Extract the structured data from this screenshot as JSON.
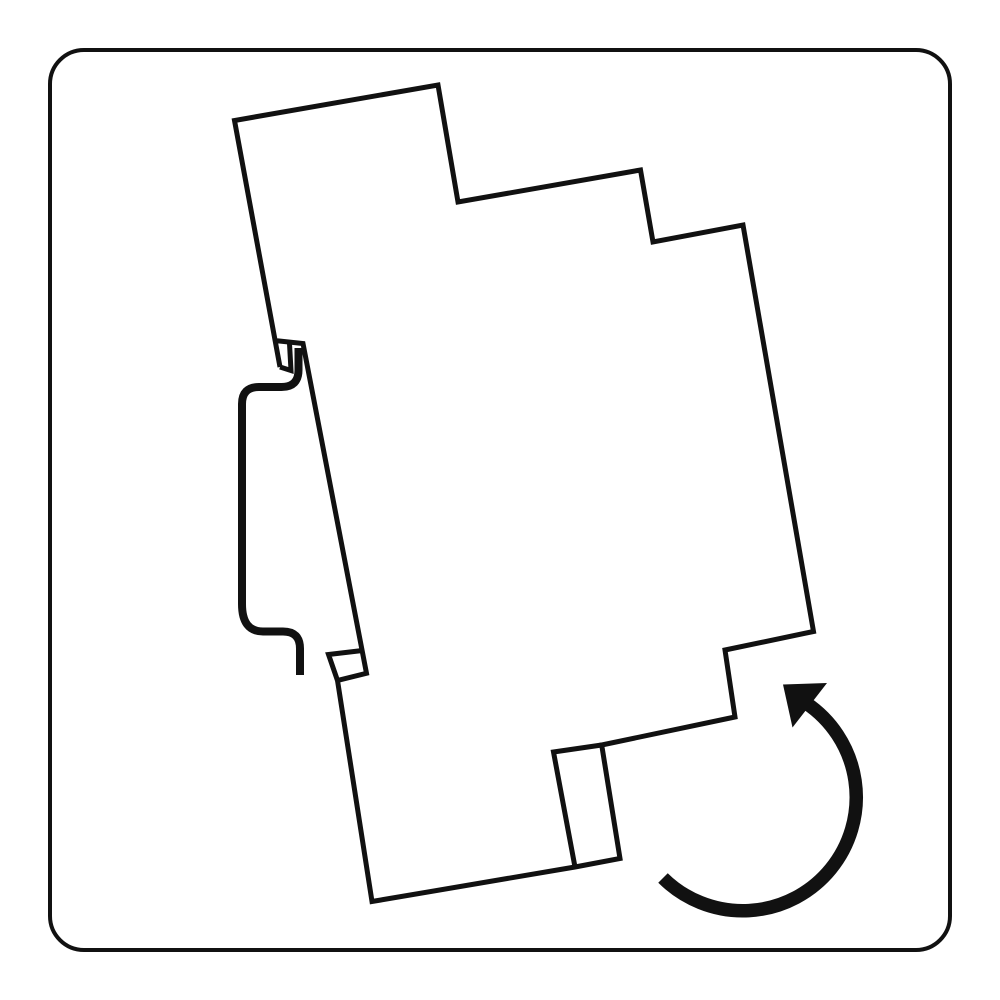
{
  "figure": {
    "kind": "technical-illustration",
    "subject": "din-rail-module-mounting-rotation",
    "has_text": false
  },
  "canvas": {
    "width": 1000,
    "height": 1000,
    "background": "#ffffff",
    "ink": "#111111"
  },
  "shapes": [
    {
      "name": "border-frame",
      "tag": "rect",
      "attrs": {
        "x": 50,
        "y": 50,
        "width": 900,
        "height": 900,
        "rx": 34,
        "ry": 34,
        "fill": "#ffffff",
        "stroke": "#111111",
        "stroke-width": 4
      }
    },
    {
      "name": "device-outline",
      "tag": "path",
      "attrs": {
        "d": "M 280 367 L 234.5 120.5 L 438 85 L 458 202 L 640.5 170 L 653 242 L 743 225 L 813.5 631.5 L 725 650 L 735 717 L 601.7 745 L 620 858.5 L 575 867 L 372 901.5 L 337.5 680.5 L 366.5 673.3 L 303 343.5 L 274.5 340.5",
        "fill": "none",
        "stroke": "#111111",
        "stroke-width": 5,
        "stroke-linejoin": "miter",
        "stroke-linecap": "butt"
      }
    },
    {
      "name": "upper-hook-slot",
      "tag": "path",
      "attrs": {
        "d": "M 280 367 L 291 370.5 L 289.5 343.5",
        "fill": "none",
        "stroke": "#111111",
        "stroke-width": 5,
        "stroke-linejoin": "miter",
        "stroke-linecap": "butt"
      }
    },
    {
      "name": "lower-snap-clip",
      "tag": "path",
      "attrs": {
        "d": "M 362.5 650.5 L 328.5 654.5 L 337.5 680.5",
        "fill": "none",
        "stroke": "#111111",
        "stroke-width": 5,
        "stroke-linejoin": "miter",
        "stroke-linecap": "butt"
      }
    },
    {
      "name": "release-tab",
      "tag": "path",
      "attrs": {
        "d": "M 601.7 745 L 553.5 752 L 575 867",
        "fill": "none",
        "stroke": "#111111",
        "stroke-width": 5,
        "stroke-linejoin": "miter",
        "stroke-linecap": "butt"
      }
    },
    {
      "name": "din-rail-profile",
      "tag": "path",
      "attrs": {
        "d": "M 298.5 348 L 298.5 370 Q 298.5 387 281.5 387 L 259 387 Q 242 387 242 404 L 242 604 Q 242 631.5 263 631.5 L 283 631.5 Q 300 631.5 300 648.5 L 300 675",
        "fill": "none",
        "stroke": "#111111",
        "stroke-width": 8,
        "stroke-linejoin": "round",
        "stroke-linecap": "butt"
      }
    },
    {
      "name": "rotation-arrow-arc",
      "tag": "path",
      "attrs": {
        "d": "M 663 878 A 113.5 113.5 0 1 0 806 703",
        "fill": "none",
        "stroke": "#111111",
        "stroke-width": 13.5,
        "stroke-linecap": "butt"
      }
    },
    {
      "name": "rotation-arrow-head",
      "tag": "path",
      "attrs": {
        "d": "M 783 684.5 L 827 683 L 792.5 727.5 Z",
        "fill": "#111111",
        "stroke": "none"
      }
    }
  ]
}
